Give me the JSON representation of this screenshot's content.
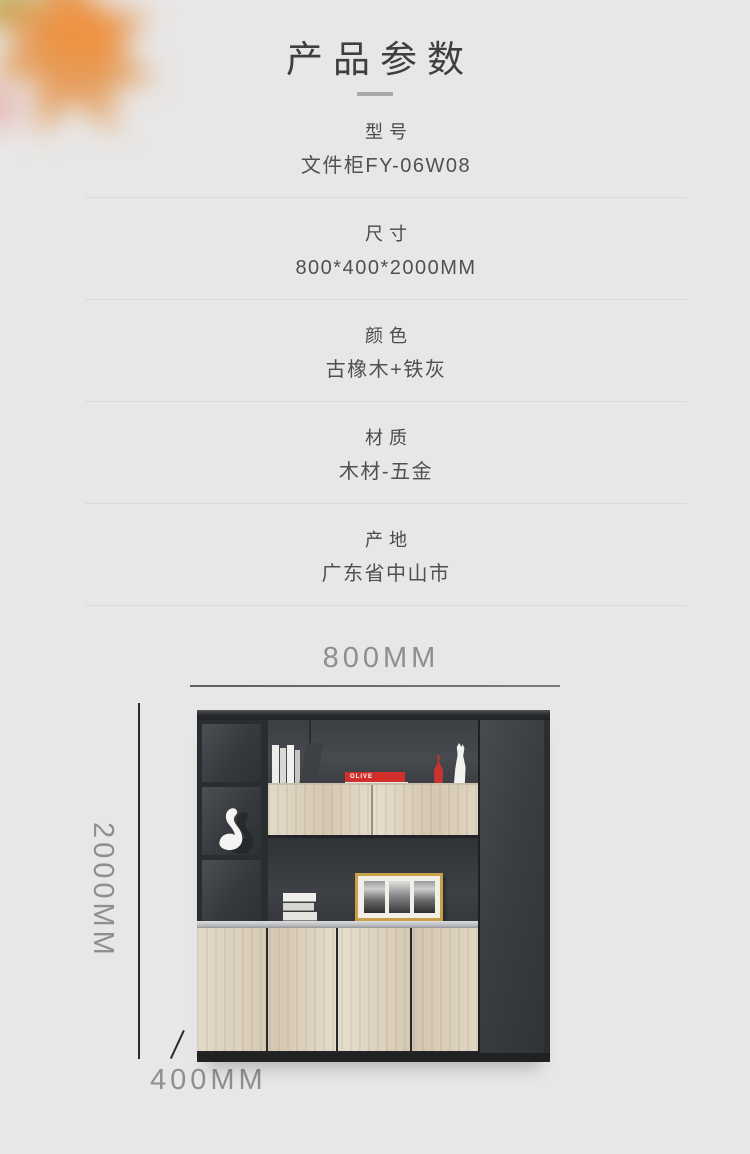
{
  "page": {
    "title": "产品参数"
  },
  "specs": {
    "rows": [
      {
        "label": "型号",
        "value": "文件柜FY-06W08"
      },
      {
        "label": "尺寸",
        "value": "800*400*2000MM"
      },
      {
        "label": "颜色",
        "value": "古橡木+铁灰"
      },
      {
        "label": "材质",
        "value": "木材-五金"
      },
      {
        "label": "产地",
        "value": "广东省中山市"
      }
    ]
  },
  "figure": {
    "width_label": "800MM",
    "height_label": "2000MM",
    "depth_label": "400MM",
    "decor": {
      "red_book_text": "OLIVE",
      "white_book_text": "◎ HOME"
    }
  },
  "colors": {
    "background": "#e8e7e7",
    "title_text": "#3e3f40",
    "spec_text": "#4c4c4c",
    "divider": "#dbdada",
    "dimension_text": "#8f8f8f",
    "dimension_line": "#2c2c2c",
    "cabinet_dark": "#35383c",
    "cabinet_wood": "#ddd2bf",
    "aluminum_strip": "#c0c2c4",
    "accent_red": "#cf2f2c",
    "frame_gold": "#c9a04a",
    "leaf_orange": "#e59a54"
  }
}
